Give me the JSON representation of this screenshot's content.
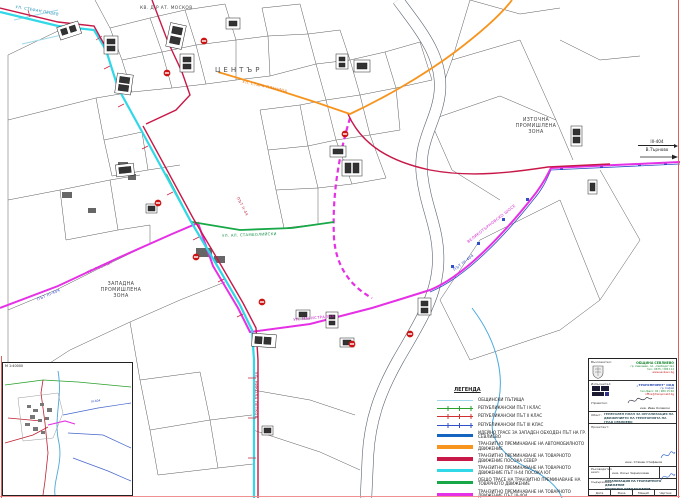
{
  "map": {
    "labels": {
      "district_nw": "КВ. Д-Р АТ. МОСКОВ",
      "center": "ЦЕНТЪР",
      "zone_west": "ЗАПАДНА\nПРОМИШЛЕНА\nЗОНА",
      "zone_east": "ИЗТОЧНА\nПРОМИШЛЕНА\nЗОНА",
      "road_ne_number": "ІІІ-404",
      "road_ne_dest": "В.Търново",
      "street_stefan_peshev": "УЛ. СТЕФАН ПЕШЕВ",
      "street_stara_planina": "УЛ. СТАРА ПЛАНИНА",
      "street_nikola_petkov": "УЛ. НИКОЛА ПЕТКОВ",
      "street_magistralna": "УЛ. МАГИСТРАЛНА",
      "street_stamboliyski": "УЛ. АЛ. СТАМБОЛИЙСКИ",
      "street_rositsa": "УЛ. РОСИЦА",
      "road_ii44": "ПЪТ ІІ-44",
      "road_iii404": "ПЪТ ІІІ-404",
      "road_velikotarnovsko": "ВЕЛИКОТЪРНОВСКО ШОСЕ"
    }
  },
  "inset": {
    "scale_label": "М 1:40000",
    "road_label": "ІІІ-404"
  },
  "legend": {
    "title": "ЛЕГЕНДА",
    "items": [
      {
        "label": "ОБЩИНСКИ ПЪТИЩА"
      },
      {
        "label": "РЕПУБЛИКАНСКИ ПЪТ І КЛАС"
      },
      {
        "label": "РЕПУБЛИКАНСКИ ПЪТ ІІ КЛАС"
      },
      {
        "label": "РЕПУБЛИКАНСКИ ПЪТ ІІІ КЛАС"
      },
      {
        "label": "ИДЕЙНО ТРАСЕ ЗА ЗАПАДЕН ОБХОДЕН ПЪТ НА ГР. СЕВЛИЕВО"
      },
      {
        "label": "ТРАНЗИТНО ПРЕМИНАВАНЕ НА АВТОМОБИЛНОТО ДВИЖЕНИЕ"
      },
      {
        "label": "ТРАНЗИТНО ПРЕМИНАВАНЕ НА ТОВАРНОТО ДВИЖЕНИЕ ПОСОКА СЕВЕР"
      },
      {
        "label": "ТРАНЗИТНО ПРЕМИНАВАНЕ НА ТОВАРНОТО ДВИЖЕНИЕ ПЪТ ІІ-44 ПОСОКА ЮГ"
      },
      {
        "label": "ОБЩО ТРАСЕ НА ТРАНЗИТНО ПРЕМИНАВАНЕ НА ТОВАРНОТО ДВИЖЕНИЕ"
      },
      {
        "label": "ТРАНЗИТНО ПРЕМИНАВАНЕ НА ТОВАРНОТО ДВИЖЕНИЕ ПЪТ ІІІ-404"
      },
      {
        "label": "НЕИЗГРАДЕН УЧАСТЪК ОТ ПРЕДЛОЖЕНИЕ ЗА\nТРАНЗИТНО ПРЕМИНАВАНЕ НА ТОВАРНОТО ДВИЖЕНИЕ"
      }
    ]
  },
  "titleblock": {
    "client_label": "Възложител:",
    "client_name": "ОБЩИНА СЕВЛИЕВО",
    "client_line1": "гр. Севлиево, пл. „Свобода\" №1",
    "client_line2": "тел.: 0675 / 396 114",
    "client_line3": "www.sevlievo.bg",
    "contractor_label": "Изпълнител:",
    "contractor_name": "„ТРАНСПРОЕКТ\" ООД",
    "contractor_line1": "гр. София",
    "contractor_line2": "тел./факс: 02 / 980 15 66",
    "contractor_line3": "office@transproekt.bg",
    "manager_label": "Управител:",
    "manager_name": "инж. Иван Колевски",
    "object_label": "Обект:",
    "object_text": "ГЕНЕРАЛЕН ПЛАН ЗА ОРГАНИЗАЦИЯ НА ДВИЖЕНИЕТО НА ТЕРИТОРИЯТА НА ГРАД СЕВЛИЕВО",
    "designer_label": "Проектант:",
    "designer_name": "инж. Стамен Стефанов",
    "lead_label": "Ръководител екип:",
    "lead_name": "инж. Косьо Чернокожев",
    "content_label": "Съдържание:",
    "content_text": "ОРГАНИЗАЦИЯ НА ТРАНЗИТНОТО ДВИЖЕНИЕ\nПРОЕКТНО ПРЕДЛОЖЕНИЕ",
    "footer": {
      "date": "Дата",
      "phase": "Фаза",
      "scale": "Мащаб",
      "sheet": "Чертеж"
    }
  },
  "colors": {
    "municipal": "#9fd8ea",
    "class1": "#2ca02c",
    "class2": "#d03030",
    "class3": "#3050c8",
    "bypass": "#1565c0",
    "auto_transit": "#f7941d",
    "freight_north": "#c81848",
    "freight_south_ii44": "#30d8e8",
    "freight_common": "#18a848",
    "freight_iii404": "#e530e5",
    "unbuilt_section": "#e530e5",
    "river_outline": "#5a6470",
    "stream": "#4aa8e0",
    "sheet_border": "#e06060"
  }
}
